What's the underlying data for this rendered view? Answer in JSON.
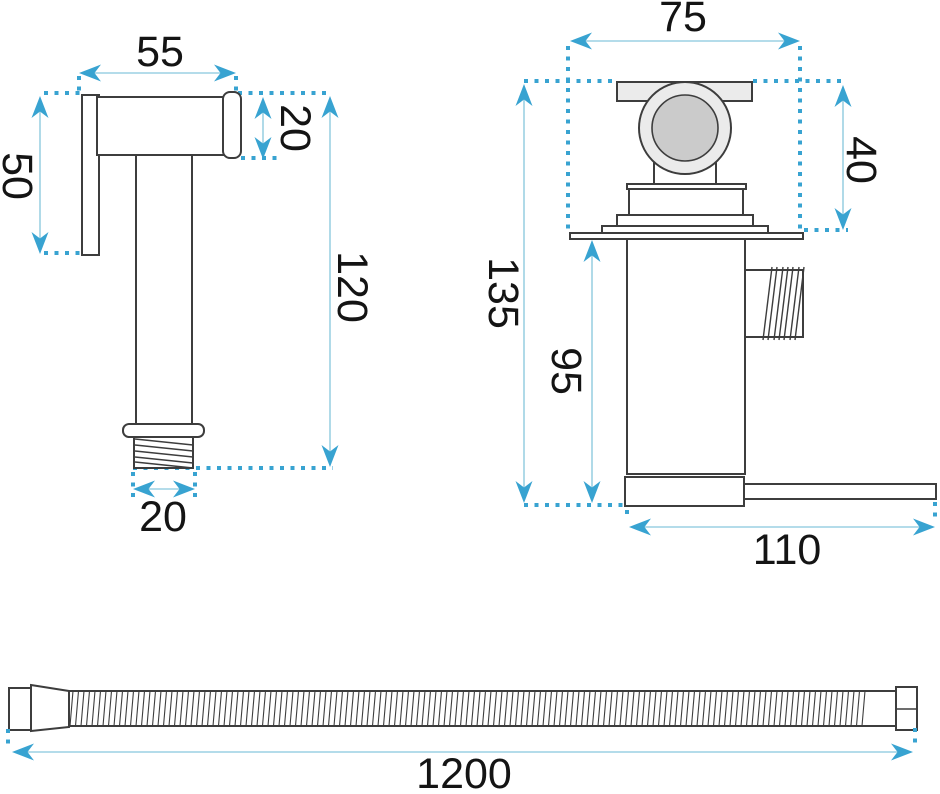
{
  "diagram": {
    "type": "technical-dimension-drawing",
    "product": "bidet sprayer set (sprayer, mixer valve, hose)",
    "colors": {
      "outline": "#3d3d3d",
      "dimension_accent": "#38a3d1",
      "dimension_line": "#9cd0e3",
      "label_text": "#141414",
      "fill_light": "#ebebeb",
      "fill_mid": "#cbcbcb",
      "background": "#ffffff"
    },
    "sprayer": {
      "head_width": "55",
      "head_height": "20",
      "face_height": "50",
      "body_length": "120",
      "thread_width": "20"
    },
    "valve": {
      "handle_width": "75",
      "handle_height": "40",
      "total_height": "135",
      "body_height": "95",
      "base_width": "110"
    },
    "hose": {
      "length": "1200"
    }
  }
}
